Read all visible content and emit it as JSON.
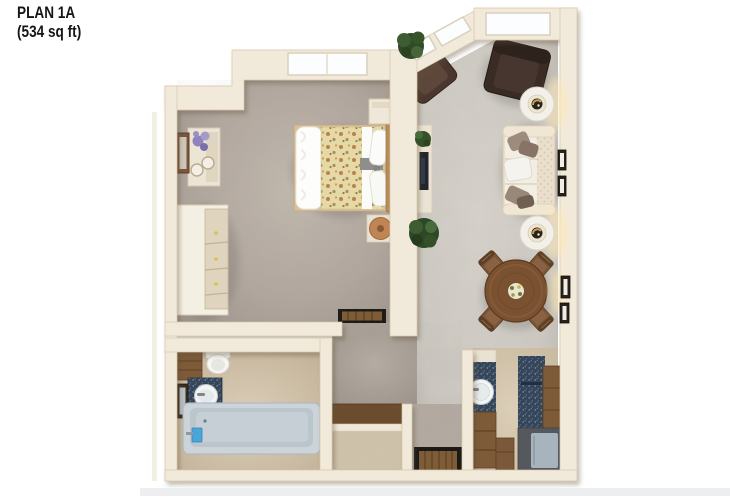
{
  "title": {
    "plan_name": "PLAN 1A",
    "area": "(534 sq ft)"
  },
  "floorplan": {
    "view": "3d-top-down-render",
    "rooms": [
      {
        "name": "bedroom",
        "floor": "taupe-carpet",
        "items": [
          "window",
          "bed-floral-duvet",
          "headboard",
          "nightstand",
          "round-stool",
          "vanity-table-with-flowers",
          "wall-mirror",
          "dresser",
          "door-mat"
        ]
      },
      {
        "name": "living-dining-room",
        "floor": "light-gray-carpet",
        "items": [
          "corner-windows",
          "corner-plant",
          "armchair",
          "armchair",
          "lamp-side-table",
          "sofa-with-pillows",
          "lamp-side-table",
          "tv-console",
          "tv",
          "console-plant",
          "floor-plant",
          "wall-frames",
          "round-dining-table",
          "dining-chair",
          "dining-chair",
          "dining-chair",
          "dining-chair",
          "centerpiece"
        ]
      },
      {
        "name": "kitchen",
        "floor": "beige-tile",
        "items": [
          "sink-counter",
          "round-sink",
          "base-cabinet",
          "tall-counter",
          "wood-cabinet",
          "refrigerator",
          "bottom-cabinet"
        ]
      },
      {
        "name": "bathroom",
        "floor": "beige-tile",
        "items": [
          "toilet",
          "wall-cabinet",
          "vanity-sink",
          "wall-mirror",
          "bathtub",
          "tub-faucet"
        ]
      },
      {
        "name": "hall-entry",
        "floor": "taupe-carpet",
        "items": [
          "entry-door-mat"
        ]
      },
      {
        "name": "closet",
        "floor": "beige-tile",
        "items": [
          "closet-shelf"
        ]
      }
    ],
    "palette": {
      "background": "#ffffff",
      "wall_cream": "#f1e9da",
      "wall_edge": "#d9c7aa",
      "bedroom_carpet": "#b1a79e",
      "living_carpet": "#cdc9c2",
      "tile_beige": "#d6c8af",
      "wood_dark": "#7b5636",
      "armchair_brown": "#46352b",
      "sofa_cream": "#eadfcc",
      "counter_navy": "#36465a",
      "tub_gray_blue": "#c6d0d6",
      "fridge_panel": "#a8b4bd",
      "mat_border": "#1c1a18",
      "mat_brown": "#7d5c36",
      "plant_green": "#declare2f4a28",
      "lamp_gold": "#c9a24a",
      "title_text": "#161616"
    }
  }
}
